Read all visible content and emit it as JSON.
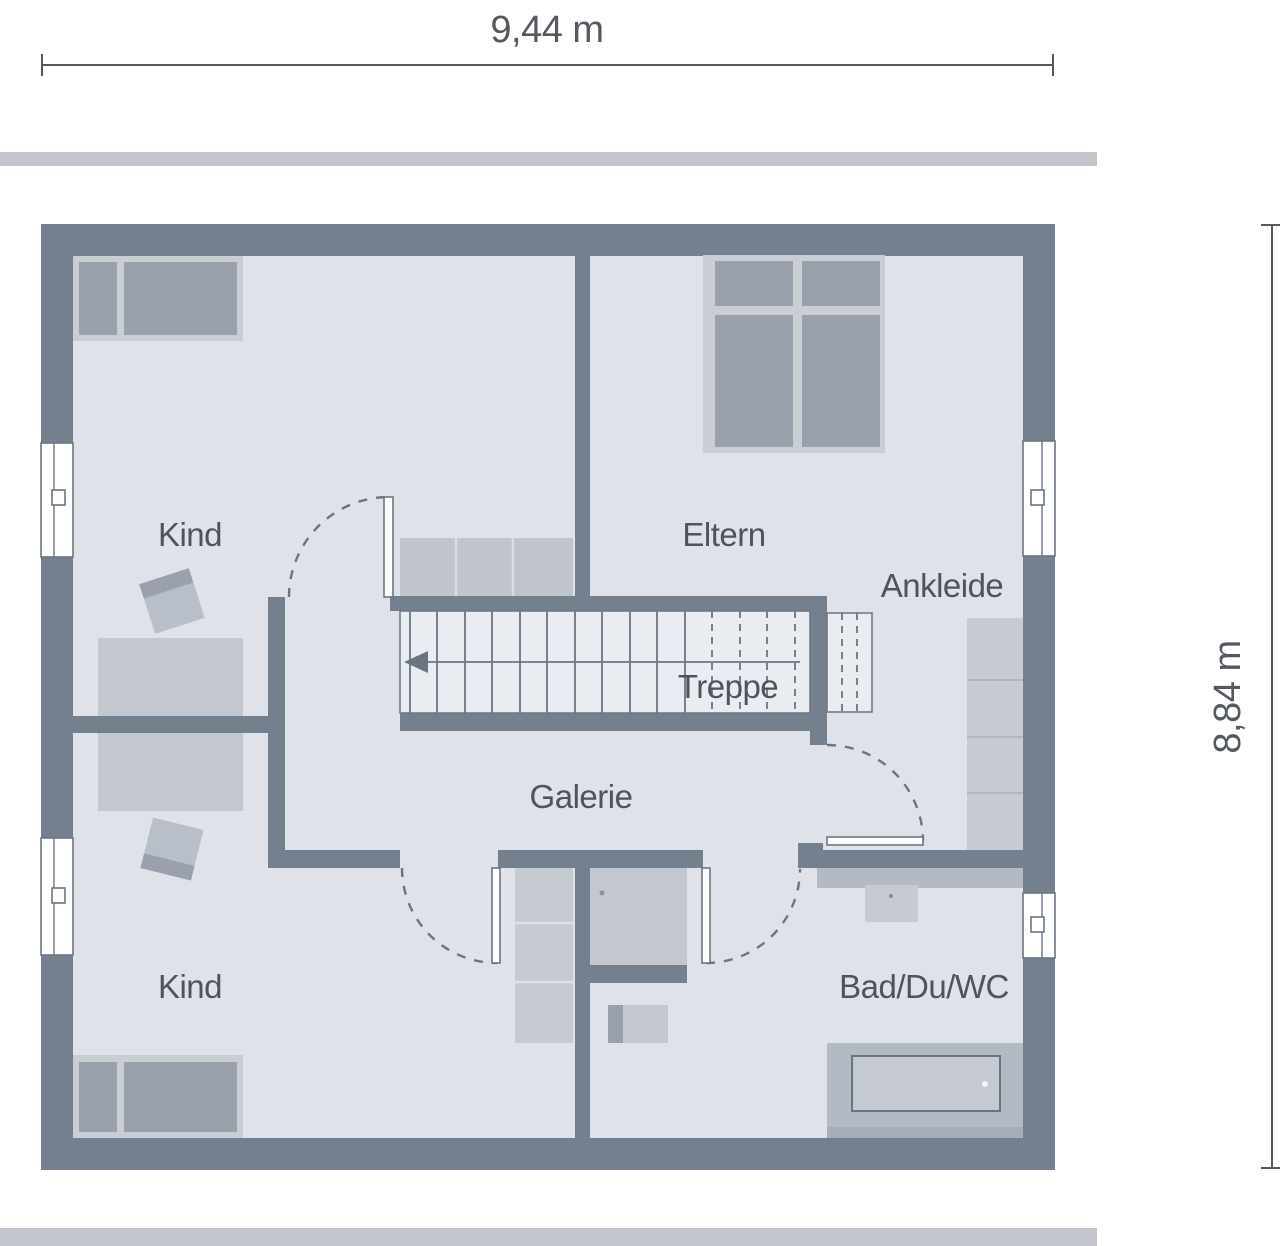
{
  "dimensions": {
    "width_label": "9,44 m",
    "height_label": "8,84 m"
  },
  "rooms": {
    "kind_top": {
      "label": "Kind"
    },
    "eltern": {
      "label": "Eltern"
    },
    "ankleide": {
      "label": "Ankleide"
    },
    "treppe": {
      "label": "Treppe"
    },
    "galerie": {
      "label": "Galerie"
    },
    "kind_bottom": {
      "label": "Kind"
    },
    "bad": {
      "label": "Bad/Du/WC"
    }
  },
  "colors": {
    "wall": "#75808F",
    "floor": "#DFE2E9",
    "stair_fill": "#E9ECF0",
    "outline": "#6A7583",
    "furniture_dark": "#9BA1AC",
    "furniture_mid": "#B9BFC8",
    "furniture_light": "#C9CDD4",
    "counter": "#B3BAC4",
    "window": "#FFFFFF",
    "label_text": "#4E535D",
    "dimension_text": "#54585F",
    "dimension_bar": "#C2C6CC"
  }
}
